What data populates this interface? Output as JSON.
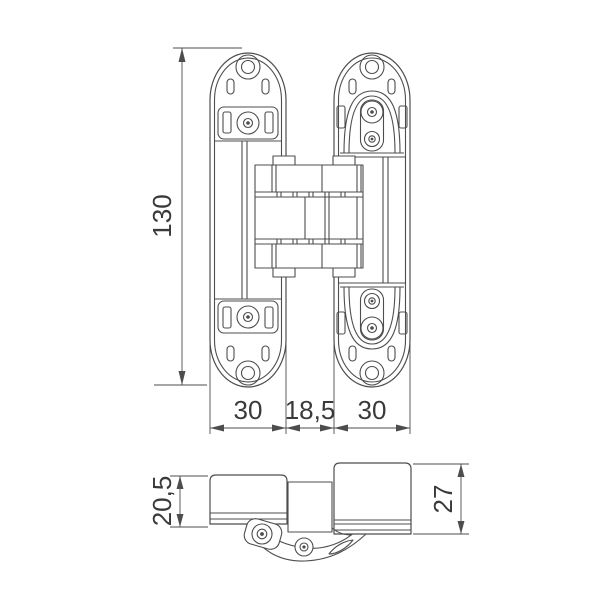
{
  "dimensions": {
    "overall_height": "130",
    "left_leaf_width": "30",
    "center_gap_width": "18,5",
    "right_leaf_width": "30",
    "left_leaf_depth": "20,5",
    "right_leaf_depth": "27"
  },
  "colors": {
    "line": "#4d4d4d",
    "dimension_text": "#3a3a3a",
    "background": "#ffffff"
  },
  "icons": {
    "screw_head": "circle-with-hex-socket",
    "mounting_slot": "rounded-slot",
    "dimension_arrowhead": "filled-triangle"
  }
}
